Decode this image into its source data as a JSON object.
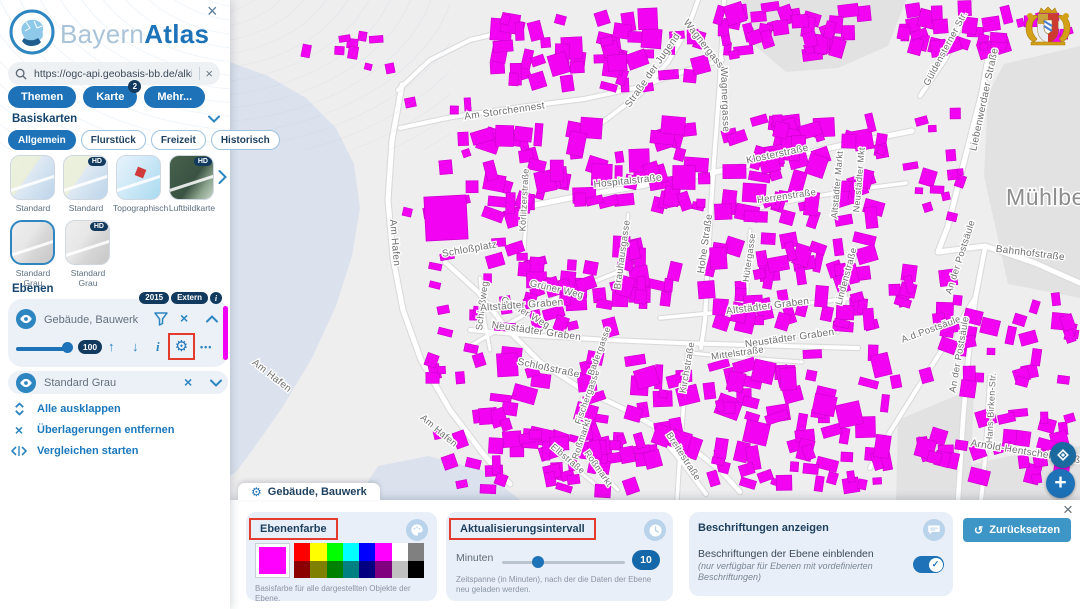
{
  "brand": {
    "light": "Bayern",
    "bold": "Atlas"
  },
  "glyphs": {
    "close": "×",
    "gear": "⚙",
    "dots": "•••",
    "arrow_up": "↑",
    "arrow_down": "↓",
    "info": "i",
    "layer_info": "i",
    "reset": "↺",
    "plus": "+",
    "check": "✓"
  },
  "sidebar": {
    "search": {
      "value": "https://ogc-api.geobasis-bb.de/alkis-verein"
    },
    "nav": [
      {
        "label": "Themen"
      },
      {
        "label": "Karte",
        "badge": "2"
      },
      {
        "label": "Mehr..."
      }
    ],
    "basiskarten": {
      "title": "Basiskarten",
      "hd_badge": "HD",
      "chips": [
        {
          "label": "Allgemein",
          "selected": true
        },
        {
          "label": "Flurstück",
          "selected": false
        },
        {
          "label": "Freizeit",
          "selected": false
        },
        {
          "label": "Historisch",
          "selected": false
        }
      ],
      "thumbs": [
        {
          "label": "Standard"
        },
        {
          "label": "Standard"
        },
        {
          "label": "Topographisch"
        },
        {
          "label": "Luftbildkarte"
        },
        {
          "label": "Standard Grau"
        },
        {
          "label": "Standard Grau"
        }
      ]
    },
    "ebenen": {
      "title": "Ebenen",
      "layer1": {
        "name": "Gebäude, Bauwerk",
        "badge_year": "2015",
        "badge_extern": "Extern",
        "opacity": "100",
        "color": "#f202f2"
      },
      "layer2": {
        "name": "Standard Grau"
      },
      "actions": [
        {
          "label": "Alle ausklappen"
        },
        {
          "label": "Überlagerungen entfernen"
        },
        {
          "label": "Vergleichen starten"
        }
      ]
    }
  },
  "panel": {
    "tab_title": "Gebäude, Bauwerk",
    "color_card": {
      "title": "Ebenenfarbe",
      "current": "#ff00ff",
      "palette": [
        "#ff0000",
        "#ffff00",
        "#00ff00",
        "#00ffff",
        "#0000ff",
        "#ff00ff",
        "#ffffff",
        "#808080",
        "#8b0000",
        "#808000",
        "#008000",
        "#008080",
        "#000080",
        "#800080",
        "#c0c0c0",
        "#000000"
      ],
      "caption": "Basisfarbe für alle dargestellten Objekte der Ebene."
    },
    "interval_card": {
      "title": "Aktualisierungsintervall",
      "unit": "Minuten",
      "value": "10",
      "caption": "Zeitspanne (in Minuten), nach der die Daten der Ebene neu geladen werden."
    },
    "labels_card": {
      "title": "Beschriftungen anzeigen",
      "text": "Beschriftungen der Ebene einblenden",
      "note": "(nur verfügbar für Ebenen mit vordefinierten Beschriftungen)",
      "toggle_on": true
    },
    "reset_label": "Zurücksetzen"
  },
  "map": {
    "colors": {
      "bg": "#efeeef",
      "water": "#dbe2ee",
      "field": "#e3e2e3",
      "road": "#ffffff",
      "road_casing": "#dadada",
      "building": "#f204f2",
      "building_stroke": "#cf00cf",
      "label": "#6f6f6f",
      "place_label": "#8d8d8d"
    },
    "place_label": "Mühlberg",
    "water": [
      "230,62 268,76 306,98 336,128 354,164 360,208 352,256 336,306 312,358 282,408 254,448 236,472 230,476",
      "356,500 378,466 428,456 482,470 520,500"
    ],
    "fields": [
      "742,0 906,0 888,46 838,68 786,72 748,40",
      "1004,64 1080,46 1080,298 1008,284 984,176 988,94",
      "928,474 1010,456 1080,446 1080,500 932,500",
      "898,420 974,388 970,500 896,500"
    ],
    "roads": [
      {
        "p": "402,85 392,140 388,200 393,258 403,310 421,360 450,410 484,455 510,484",
        "w": 5
      },
      {
        "p": "400,128 452,117 520,107 584,99 640,87 688,70 722,60",
        "w": 4
      },
      {
        "p": "600,124 640,94 668,62 688,28 698,0",
        "w": 4
      },
      {
        "p": "724,0 720,80 714,160 709,240 705,320 701,348",
        "w": 4
      },
      {
        "p": "530,206 580,196 640,186 700,175 760,163 820,150 882,137 912,131",
        "w": 5
      },
      {
        "p": "740,212 800,199 860,189 906,183",
        "w": 3.5
      },
      {
        "p": "993,30 982,92 964,162 948,226 938,252",
        "w": 5
      },
      {
        "p": "938,252 985,246 1035,263 1080,283",
        "w": 5
      },
      {
        "p": "985,248 975,300 968,360 963,420 960,470 958,500",
        "w": 4.5
      },
      {
        "p": "975,298 945,345 915,392 890,432 870,468",
        "w": 4
      },
      {
        "p": "990,378 987,432 983,482 981,500",
        "w": 4
      },
      {
        "p": "470,330 540,336 610,340 680,343 750,345 820,347 858,348",
        "w": 4
      },
      {
        "p": "660,318 722,312 784,306 852,298",
        "w": 3.5
      },
      {
        "p": "445,262 478,292 508,330 540,362 580,388 622,408 658,428 692,448 722,472 740,492",
        "w": 4.5
      },
      {
        "p": "470,346 508,324 548,302 588,284 618,272",
        "w": 3.5
      },
      {
        "p": "688,346 684,400 680,452 677,500",
        "w": 3.5
      },
      {
        "p": "655,430 682,462 706,494",
        "w": 4
      },
      {
        "p": "690,353 745,358 802,362",
        "w": 3
      },
      {
        "p": "920,96 946,58 962,22 970,0",
        "w": 4
      },
      {
        "p": "480,278 484,318 490,350",
        "w": 3
      },
      {
        "p": "750,230 748,278 746,312",
        "w": 2.5
      },
      {
        "p": "628,214 626,258 624,300",
        "w": 2.5
      },
      {
        "p": "582,398 587,438 597,468 618,490",
        "w": 3
      },
      {
        "p": "540,438 570,464 600,488",
        "w": 3
      },
      {
        "p": "856,250 846,292 838,332",
        "w": 3
      },
      {
        "p": "528,168 526,214 524,252",
        "w": 3
      },
      {
        "p": "398,90 430,60 470,40 520,28",
        "w": 4
      }
    ],
    "big_buildings": [
      {
        "x": 425,
        "y": 196,
        "w": 42,
        "h": 44,
        "r": -3
      }
    ],
    "clusters": [
      {
        "x": 480,
        "y": 8,
        "w": 230,
        "h": 85,
        "n": 55,
        "min": 7,
        "max": 22,
        "seed": 11
      },
      {
        "x": 715,
        "y": 0,
        "w": 175,
        "h": 66,
        "n": 40,
        "min": 7,
        "max": 20,
        "seed": 22
      },
      {
        "x": 893,
        "y": 0,
        "w": 118,
        "h": 58,
        "n": 26,
        "min": 7,
        "max": 18,
        "seed": 33
      },
      {
        "x": 470,
        "y": 115,
        "w": 240,
        "h": 112,
        "n": 62,
        "min": 7,
        "max": 24,
        "seed": 44
      },
      {
        "x": 708,
        "y": 112,
        "w": 195,
        "h": 118,
        "n": 55,
        "min": 7,
        "max": 24,
        "seed": 55
      },
      {
        "x": 903,
        "y": 88,
        "w": 62,
        "h": 142,
        "n": 14,
        "min": 6,
        "max": 16,
        "seed": 66
      },
      {
        "x": 468,
        "y": 235,
        "w": 218,
        "h": 102,
        "n": 52,
        "min": 7,
        "max": 22,
        "seed": 77
      },
      {
        "x": 690,
        "y": 232,
        "w": 195,
        "h": 102,
        "n": 50,
        "min": 7,
        "max": 22,
        "seed": 88
      },
      {
        "x": 468,
        "y": 345,
        "w": 232,
        "h": 132,
        "n": 60,
        "min": 7,
        "max": 24,
        "seed": 99
      },
      {
        "x": 700,
        "y": 345,
        "w": 192,
        "h": 128,
        "n": 50,
        "min": 7,
        "max": 24,
        "seed": 111
      },
      {
        "x": 888,
        "y": 255,
        "w": 112,
        "h": 148,
        "n": 26,
        "min": 6,
        "max": 18,
        "seed": 122
      },
      {
        "x": 902,
        "y": 408,
        "w": 176,
        "h": 86,
        "n": 28,
        "min": 7,
        "max": 20,
        "seed": 133
      },
      {
        "x": 1002,
        "y": 282,
        "w": 78,
        "h": 126,
        "n": 16,
        "min": 7,
        "max": 18,
        "seed": 144
      },
      {
        "x": 395,
        "y": 95,
        "w": 85,
        "h": 132,
        "n": 10,
        "min": 6,
        "max": 14,
        "seed": 155
      },
      {
        "x": 388,
        "y": 252,
        "w": 95,
        "h": 138,
        "n": 12,
        "min": 6,
        "max": 15,
        "seed": 166
      },
      {
        "x": 420,
        "y": 430,
        "w": 250,
        "h": 68,
        "n": 26,
        "min": 6,
        "max": 18,
        "seed": 177
      },
      {
        "x": 248,
        "y": 14,
        "w": 150,
        "h": 64,
        "n": 9,
        "min": 6,
        "max": 14,
        "seed": 188
      },
      {
        "x": 1012,
        "y": 2,
        "w": 66,
        "h": 44,
        "n": 8,
        "min": 6,
        "max": 14,
        "seed": 199
      },
      {
        "x": 702,
        "y": 456,
        "w": 190,
        "h": 42,
        "n": 16,
        "min": 6,
        "max": 16,
        "seed": 211
      }
    ],
    "street_labels": [
      {
        "text": "Am Storchennest",
        "x": 505,
        "y": 114,
        "r": -8,
        "s": 10
      },
      {
        "text": "Am Hafen",
        "x": 392,
        "y": 243,
        "r": 85,
        "s": 10
      },
      {
        "text": "Am Hafen",
        "x": 270,
        "y": 378,
        "r": 38,
        "s": 10
      },
      {
        "text": "Am Hafen",
        "x": 437,
        "y": 433,
        "r": 40,
        "s": 9.5
      },
      {
        "text": "Schloßplatz",
        "x": 470,
        "y": 252,
        "r": -10,
        "s": 10
      },
      {
        "text": "Schloßweg",
        "x": 485,
        "y": 306,
        "r": -83,
        "s": 9.5
      },
      {
        "text": "Grüner Weg",
        "x": 556,
        "y": 292,
        "r": 13,
        "s": 9.5
      },
      {
        "text": "Grüner Weg",
        "x": 524,
        "y": 315,
        "r": 30,
        "s": 9.5
      },
      {
        "text": "Wagnergasse",
        "x": 703,
        "y": 48,
        "r": 52,
        "s": 10
      },
      {
        "text": "Wagnergasse",
        "x": 722,
        "y": 100,
        "r": 88,
        "s": 10
      },
      {
        "text": "Straße der Jugend",
        "x": 655,
        "y": 72,
        "r": -55,
        "s": 10
      },
      {
        "text": "Güldensterner Str.",
        "x": 948,
        "y": 50,
        "r": -62,
        "s": 9.5
      },
      {
        "text": "Liebenwerdaer Straße",
        "x": 987,
        "y": 100,
        "r": -78,
        "s": 10
      },
      {
        "text": "Klosterstraße",
        "x": 778,
        "y": 157,
        "r": -12,
        "s": 10
      },
      {
        "text": "Hospitalstraße",
        "x": 628,
        "y": 184,
        "r": -6,
        "s": 10
      },
      {
        "text": "Herrenstraße",
        "x": 787,
        "y": 199,
        "r": -8,
        "s": 9.5
      },
      {
        "text": "Körlitzerstraße",
        "x": 527,
        "y": 200,
        "r": -87,
        "s": 9
      },
      {
        "text": "Brauhausgasse",
        "x": 625,
        "y": 255,
        "r": -82,
        "s": 9.5
      },
      {
        "text": "Hohe Straße",
        "x": 708,
        "y": 244,
        "r": -82,
        "s": 10
      },
      {
        "text": "Hütergasse",
        "x": 752,
        "y": 258,
        "r": -82,
        "s": 9
      },
      {
        "text": "Altstädter Markt",
        "x": 840,
        "y": 185,
        "r": -85,
        "s": 9
      },
      {
        "text": "Neustädter Mkt",
        "x": 862,
        "y": 180,
        "r": -85,
        "s": 9
      },
      {
        "text": "Lindenstraße",
        "x": 849,
        "y": 277,
        "r": -75,
        "s": 9.5
      },
      {
        "text": "Altstädter Graben",
        "x": 768,
        "y": 309,
        "r": -7,
        "s": 10
      },
      {
        "text": "Altstädter Graben",
        "x": 522,
        "y": 308,
        "r": -4,
        "s": 10
      },
      {
        "text": "Neustädter Graben",
        "x": 790,
        "y": 341,
        "r": -8,
        "s": 10
      },
      {
        "text": "Neustädter Graben",
        "x": 536,
        "y": 334,
        "r": 8,
        "s": 10
      },
      {
        "text": "Mittelstraße",
        "x": 738,
        "y": 356,
        "r": -8,
        "s": 9.5
      },
      {
        "text": "Kirchstraße",
        "x": 690,
        "y": 368,
        "r": -80,
        "s": 9.5
      },
      {
        "text": "A.d.Postsäule",
        "x": 932,
        "y": 332,
        "r": -20,
        "s": 9.5
      },
      {
        "text": "An der Postsäule",
        "x": 963,
        "y": 258,
        "r": -72,
        "s": 9.5
      },
      {
        "text": "An der Postsäule",
        "x": 962,
        "y": 355,
        "r": -80,
        "s": 9.5
      },
      {
        "text": "Bahnhofstraße",
        "x": 1030,
        "y": 256,
        "r": 7,
        "s": 10
      },
      {
        "text": "Hans-Birken-Str.",
        "x": 994,
        "y": 408,
        "r": -87,
        "s": 9
      },
      {
        "text": "Arnold-Hentschel-Straße",
        "x": 1028,
        "y": 455,
        "r": 9,
        "s": 10
      },
      {
        "text": "Breitestraße",
        "x": 681,
        "y": 458,
        "r": 57,
        "s": 9.5
      },
      {
        "text": "Schloßstraße",
        "x": 548,
        "y": 371,
        "r": 12,
        "s": 10
      },
      {
        "text": "Roßmarkt",
        "x": 584,
        "y": 440,
        "r": -72,
        "s": 9
      },
      {
        "text": "Roßmarkt",
        "x": 596,
        "y": 470,
        "r": 55,
        "s": 9
      },
      {
        "text": "Elbstraße",
        "x": 566,
        "y": 461,
        "r": 40,
        "s": 9
      },
      {
        "text": "Fischergasse",
        "x": 590,
        "y": 398,
        "r": -70,
        "s": 9
      },
      {
        "text": "Badergasse",
        "x": 602,
        "y": 352,
        "r": -70,
        "s": 9
      }
    ]
  }
}
